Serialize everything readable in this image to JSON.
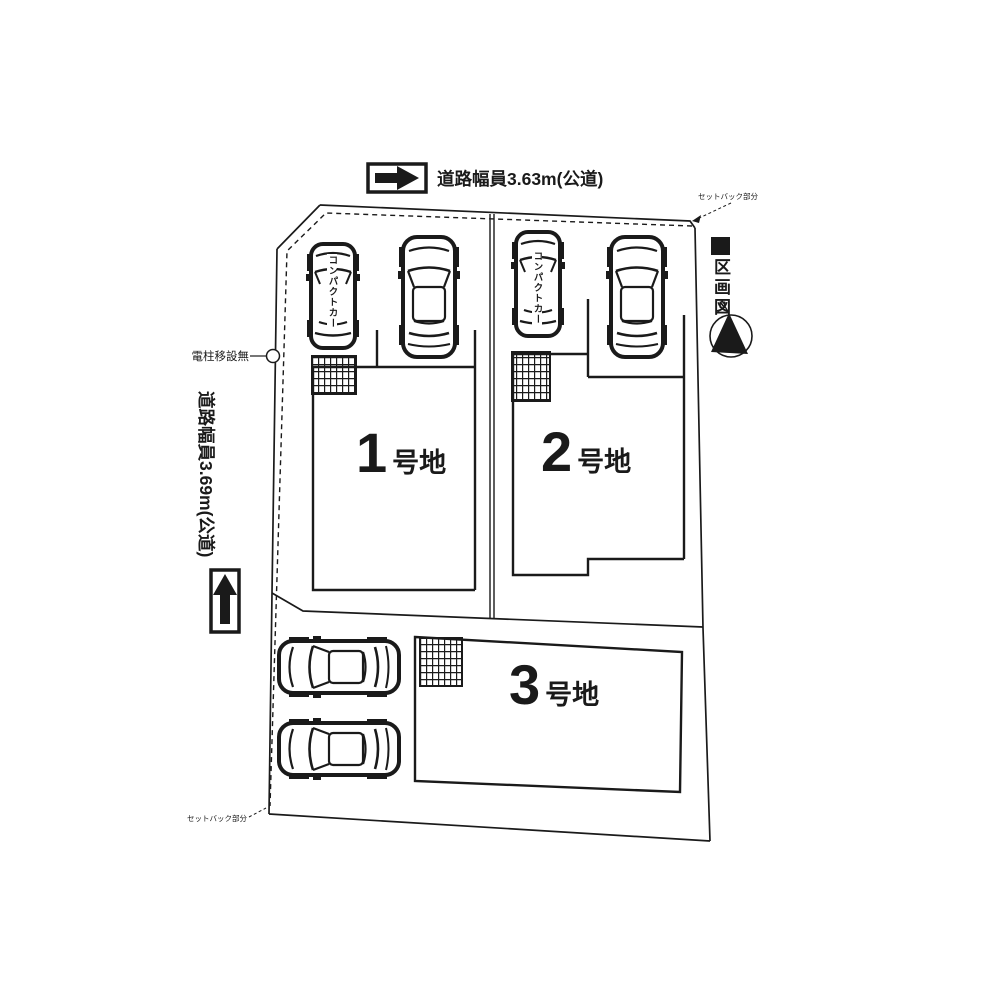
{
  "annotations": {
    "road_top": "道路幅員3.63m(公道)",
    "road_left": "道路幅員3.69m(公道)",
    "pole_note": "電柱移設無",
    "setback_top": "セットバック部分",
    "setback_bottom": "セットバック部分",
    "legend_title": "区画図",
    "compass_north": "N"
  },
  "lots": [
    {
      "number": "1",
      "suffix": "号地",
      "compact_car_label": "コンパクトカー"
    },
    {
      "number": "2",
      "suffix": "号地",
      "compact_car_label": "コンパクトカー"
    },
    {
      "number": "3",
      "suffix": "号地"
    }
  ],
  "colors": {
    "line": "#1a1a1a",
    "background": "#ffffff"
  }
}
